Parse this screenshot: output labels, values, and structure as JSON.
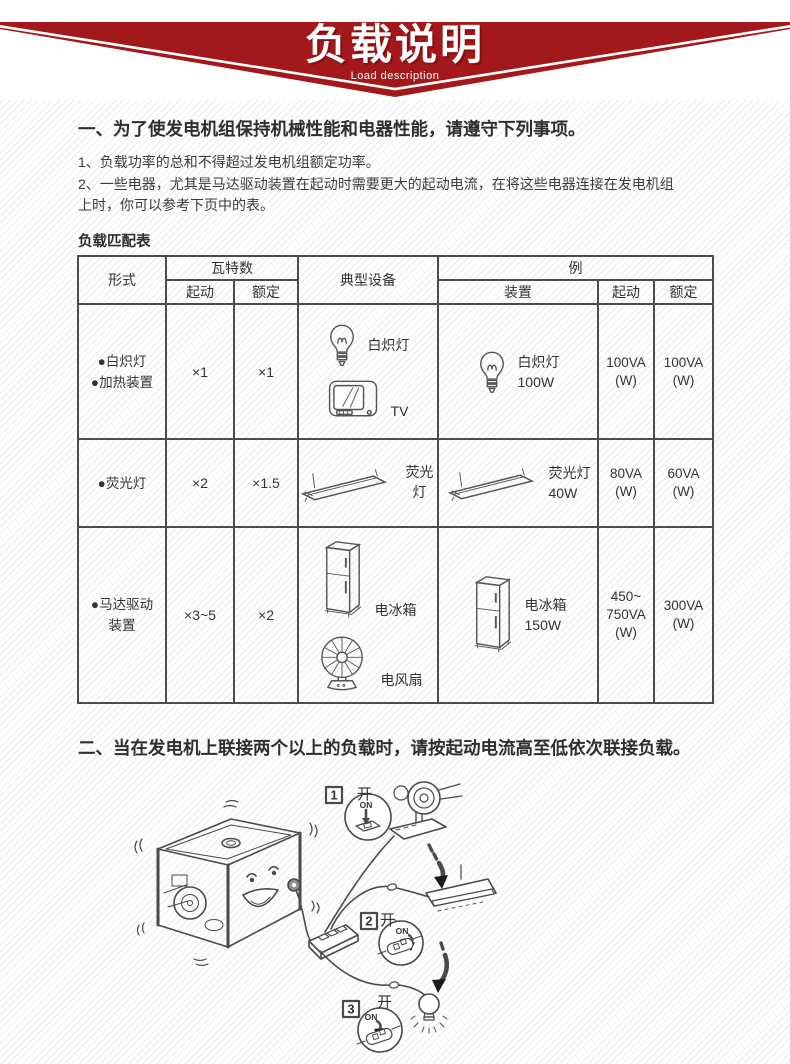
{
  "banner": {
    "title": "负载说明",
    "subtitle": "Load description",
    "red": "#a2181b"
  },
  "colors": {
    "banner_red": "#a2181b",
    "text": "#3b3b3b",
    "table_border": "#4c4c4c",
    "line_art": "#4a4a4a"
  },
  "section_one": {
    "heading": "一、为了使发电机组保持机械性能和电器性能，请遵守下列事项。",
    "items": [
      "1、负载功率的总和不得超过发电机组额定功率。",
      "2、一些电器，尤其是马达驱动装置在起动时需要更大的起动电流，在将这些电器连接在发电机组上时，你可以参考下页中的表。"
    ]
  },
  "load_table": {
    "caption": "负载匹配表",
    "headers": {
      "type": "形式",
      "wattage": "瓦特数",
      "start": "起动",
      "rated": "额定",
      "typical_device": "典型设备",
      "example": "例",
      "device": "装置"
    },
    "rows": [
      {
        "type_lines": [
          "●白炽灯",
          "●加热装置"
        ],
        "start": "×1",
        "rated": "×1",
        "typical": [
          {
            "icon": "incandescent-bulb-icon",
            "label": "白炽灯"
          },
          {
            "icon": "tv-icon",
            "label": "TV"
          }
        ],
        "example": {
          "icon": "incandescent-bulb-icon",
          "lines": [
            "白炽灯",
            "100W"
          ]
        },
        "example_start_lines": [
          "100VA",
          "(W)"
        ],
        "example_rated_lines": [
          "100VA",
          "(W)"
        ]
      },
      {
        "type_lines": [
          "●荧光灯"
        ],
        "start": "×2",
        "rated": "×1.5",
        "typical": [
          {
            "icon": "fluorescent-tube-icon",
            "label": "荧光灯"
          }
        ],
        "example": {
          "icon": "fluorescent-tube-icon",
          "lines": [
            "荧光灯",
            "40W"
          ]
        },
        "example_start_lines": [
          "80VA",
          "(W)"
        ],
        "example_rated_lines": [
          "60VA",
          "(W)"
        ]
      },
      {
        "type_lines": [
          "●马达驱动",
          "装置"
        ],
        "start": "×3~5",
        "rated": "×2",
        "typical": [
          {
            "icon": "refrigerator-icon",
            "label": "电冰箱"
          },
          {
            "icon": "fan-icon",
            "label": "电风扇"
          }
        ],
        "example": {
          "icon": "refrigerator-icon",
          "lines": [
            "电冰箱",
            "150W"
          ]
        },
        "example_start_lines": [
          "450~",
          "750VA",
          "(W)"
        ],
        "example_rated_lines": [
          "300VA",
          "(W)"
        ]
      }
    ]
  },
  "section_two": {
    "heading": "二、当在发电机上联接两个以上的负载时，请按起动电流高至低依次联接负载。"
  },
  "illustration": {
    "steps": [
      {
        "num": "1",
        "switch_label": "开",
        "on_label": "ON"
      },
      {
        "num": "2",
        "switch_label": "开",
        "on_label": "ON"
      },
      {
        "num": "3",
        "switch_label": "开",
        "on_label": "ON"
      }
    ]
  }
}
